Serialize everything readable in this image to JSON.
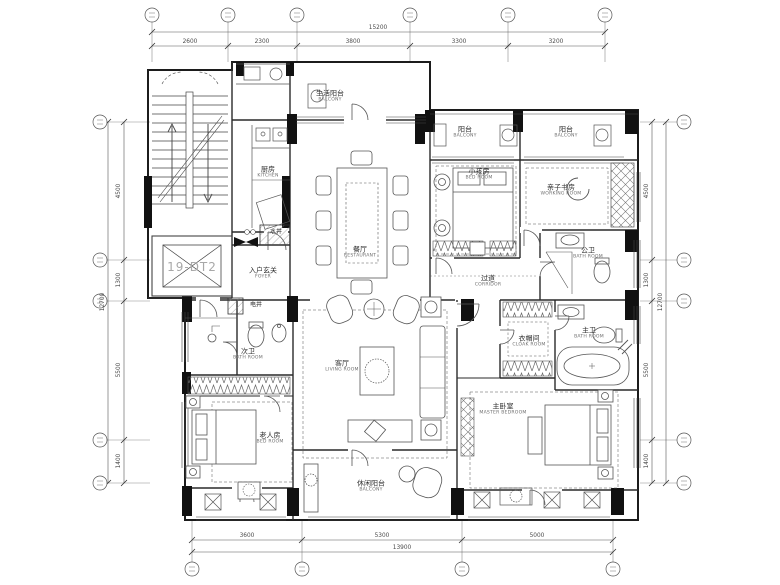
{
  "rooms": {
    "life_balcony": {
      "cn": "生活阳台",
      "en": "BALCONY"
    },
    "kitchen": {
      "cn": "厨房",
      "en": "KITCHEN"
    },
    "water_shaft": {
      "cn": "水井"
    },
    "elevator": {
      "label": "19-DT2"
    },
    "foyer": {
      "cn": "入户玄关",
      "en": "FOYER"
    },
    "electric_shaft": {
      "cn": "电井"
    },
    "dining": {
      "cn": "餐厅",
      "en": "RESTAURANT"
    },
    "balcony_1": {
      "cn": "阳台",
      "en": "BALCONY"
    },
    "balcony_2": {
      "cn": "阳台",
      "en": "BALCONY"
    },
    "kids_bedroom": {
      "cn": "小孩房",
      "en": "BED ROOM"
    },
    "working_room": {
      "cn": "亲子书房",
      "en": "WORKING ROOM"
    },
    "public_bath": {
      "cn": "公卫",
      "en": "BATH ROOM"
    },
    "corridor": {
      "cn": "过道",
      "en": "CORRIDOR"
    },
    "second_bath": {
      "cn": "次卫",
      "en": "BATH ROOM"
    },
    "living_room": {
      "cn": "客厅",
      "en": "LIVING ROOM"
    },
    "cloak_room": {
      "cn": "衣帽间",
      "en": "CLOAK ROOM"
    },
    "master_bath": {
      "cn": "主卫",
      "en": "BATH ROOM"
    },
    "elder_bedroom": {
      "cn": "老人房",
      "en": "BED ROOM"
    },
    "master_bedroom": {
      "cn": "主卧室",
      "en": "MASTER BEDROOM"
    },
    "leisure_balcony": {
      "cn": "休闲阳台",
      "en": "BALCONY"
    }
  },
  "dimensions": {
    "top": {
      "segments": [
        "2600",
        "2300",
        "3800",
        "3300",
        "3200"
      ],
      "overall": "15200"
    },
    "bottom": {
      "segments": [
        "3600",
        "5300",
        "5000"
      ],
      "overall": "13900"
    },
    "left": {
      "segments": [
        "4500",
        "1300",
        "5500",
        "1400"
      ],
      "overall": "12700"
    },
    "right": {
      "segments": [
        "4500",
        "1300",
        "5500",
        "1400"
      ],
      "overall": "12700"
    }
  },
  "colors": {
    "wall": "#1c1c1c",
    "furniture": "#555555",
    "dims": "#4a4a4a",
    "grid": "#777777"
  }
}
